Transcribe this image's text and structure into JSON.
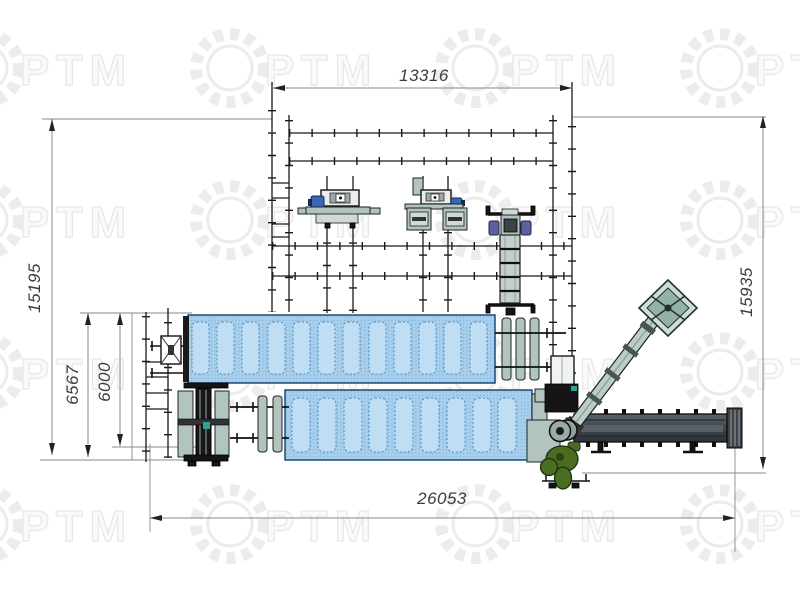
{
  "watermark": {
    "text": "РТМ"
  },
  "dimensions": {
    "top": {
      "value": "13316"
    },
    "left_outer": {
      "value": "15195"
    },
    "left_mid": {
      "value": "6567"
    },
    "left_inner": {
      "value": "6000"
    },
    "right": {
      "value": "15935"
    },
    "bottom": {
      "value": "26053"
    }
  },
  "colors": {
    "drum_blue": "#a9cfec",
    "drum_panel": "#bfddf3",
    "drum_dot": "#5b9ccd",
    "drum_border": "#0e3f6e",
    "equipment_gray": "#b2c4bf",
    "conveyor_dark": "#454b51",
    "pump_green": "#4b6d22",
    "hopper_teal": "#cdddd8",
    "motor_blue": "#3a66b8",
    "line": "#1a1a1a",
    "dim_line": "#8a8a8a",
    "dim_text": "#3c3c3c",
    "watermark_gray": "#ececec"
  }
}
